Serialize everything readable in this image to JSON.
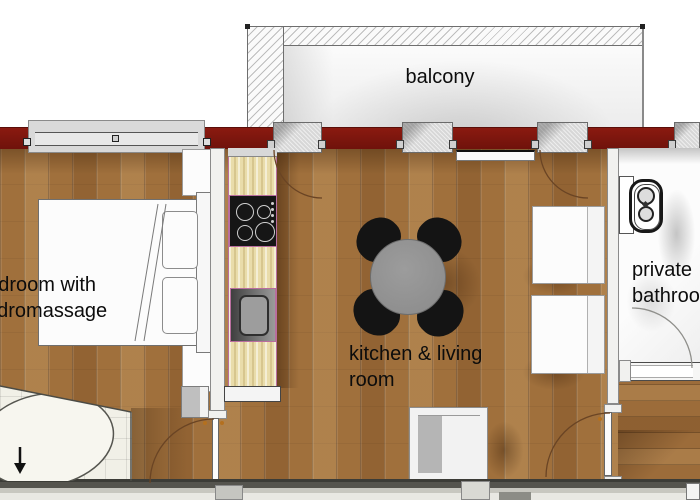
{
  "title": "apartment floor plan",
  "labels": {
    "balcony": "balcony",
    "kitchen_living_line1": "kitchen & living",
    "kitchen_living_line2": "room",
    "bedroom_line1": "bedroom with",
    "bedroom_line2": "hydromassage",
    "bathroom_line1": "private",
    "bathroom_line2": "bathroom"
  },
  "colors": {
    "wall_red": "#7d150e",
    "wood_floor": "#a0703c",
    "kitchen_counter": "#e9dcaa",
    "table_gray": "#939393",
    "chair_black": "#141414",
    "tile_white": "#f1f0e7"
  },
  "furniture": [
    "double-bed",
    "pillows",
    "nightstands",
    "hydromassage-tub",
    "kitchen-counter",
    "gas-hob",
    "kitchen-sink",
    "dining-table",
    "dining-chairs",
    "sofa-seats",
    "square-armchair",
    "sideboard",
    "toilet",
    "cabinet"
  ]
}
